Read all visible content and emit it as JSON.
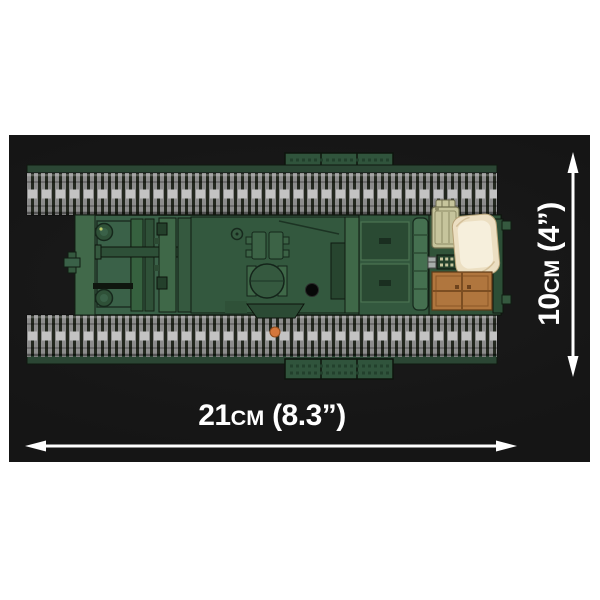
{
  "annotations": {
    "length": {
      "value": "21",
      "unit": "cm",
      "imperial": "(8.3”)"
    },
    "height": {
      "value": "10",
      "unit": "cm",
      "imperial": "(4”)"
    }
  },
  "palette": {
    "background": "#ffffff",
    "photo_bg": "#151515",
    "annotation": "#ffffff",
    "hull_green": "#3a6148",
    "hull_dark_green": "#2b4a34",
    "track_gray": "#8d8d8d",
    "jerry_can_khaki": "#c6c49c",
    "sandbag_cream": "#ecdfc2",
    "crate_brown": "#b0763e",
    "marker_orange": "#d4763b"
  }
}
